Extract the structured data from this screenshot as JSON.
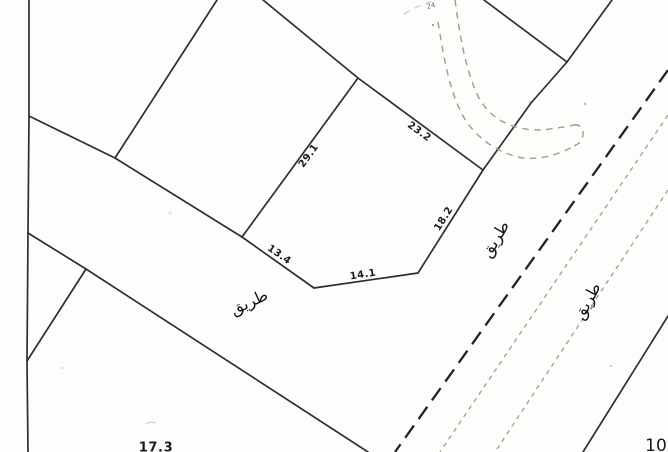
{
  "map": {
    "background_color": "#fdfdfc",
    "parcel_line_color": "#1f1f1f",
    "thin_dash_color": "#a19c8f",
    "dimension_labels": {
      "d23_2": "23.2",
      "d29_1": "29.1",
      "d18_2": "18.2",
      "d13_4": "13.4",
      "d14_1": "14.1",
      "d17_3": "17.3",
      "d10": "10",
      "tiny_note": "24"
    },
    "road_labels": {
      "left": "طريق",
      "center": "طريق",
      "right": "طريق"
    }
  },
  "map_data": {
    "type": "cadastral_plan",
    "central_parcel": {
      "vertices_px": [
        [
          358,
          78
        ],
        [
          483,
          170
        ],
        [
          418,
          273
        ],
        [
          314,
          288
        ],
        [
          242,
          237
        ]
      ],
      "side_lengths": [
        23.2,
        18.2,
        14.1,
        13.4,
        29.1
      ]
    },
    "dimensions": [
      {
        "value": 23.2,
        "from_px": [
          358,
          78
        ],
        "to_px": [
          483,
          170
        ]
      },
      {
        "value": 29.1,
        "from_px": [
          242,
          237
        ],
        "to_px": [
          358,
          78
        ]
      },
      {
        "value": 18.2,
        "from_px": [
          483,
          170
        ],
        "to_px": [
          418,
          273
        ]
      },
      {
        "value": 14.1,
        "from_px": [
          418,
          273
        ],
        "to_px": [
          314,
          288
        ]
      },
      {
        "value": 13.4,
        "from_px": [
          242,
          237
        ],
        "to_px": [
          314,
          288
        ]
      },
      {
        "value": 17.3,
        "label_px": [
          156,
          447
        ],
        "note": "clipped at bottom edge"
      },
      {
        "value": 10,
        "label_px": [
          656,
          444
        ],
        "note": "clipped at bottom edge"
      }
    ],
    "roads": [
      {
        "name": "طريق",
        "label_px": [
          249,
          302
        ],
        "style": "open band between solid parcel boundaries"
      },
      {
        "name": "طريق",
        "label_px": [
          495,
          239
        ],
        "style": "bold dashed centerline"
      },
      {
        "name": "طريق",
        "label_px": [
          587,
          301
        ],
        "style": "thin dashed edges"
      }
    ]
  }
}
